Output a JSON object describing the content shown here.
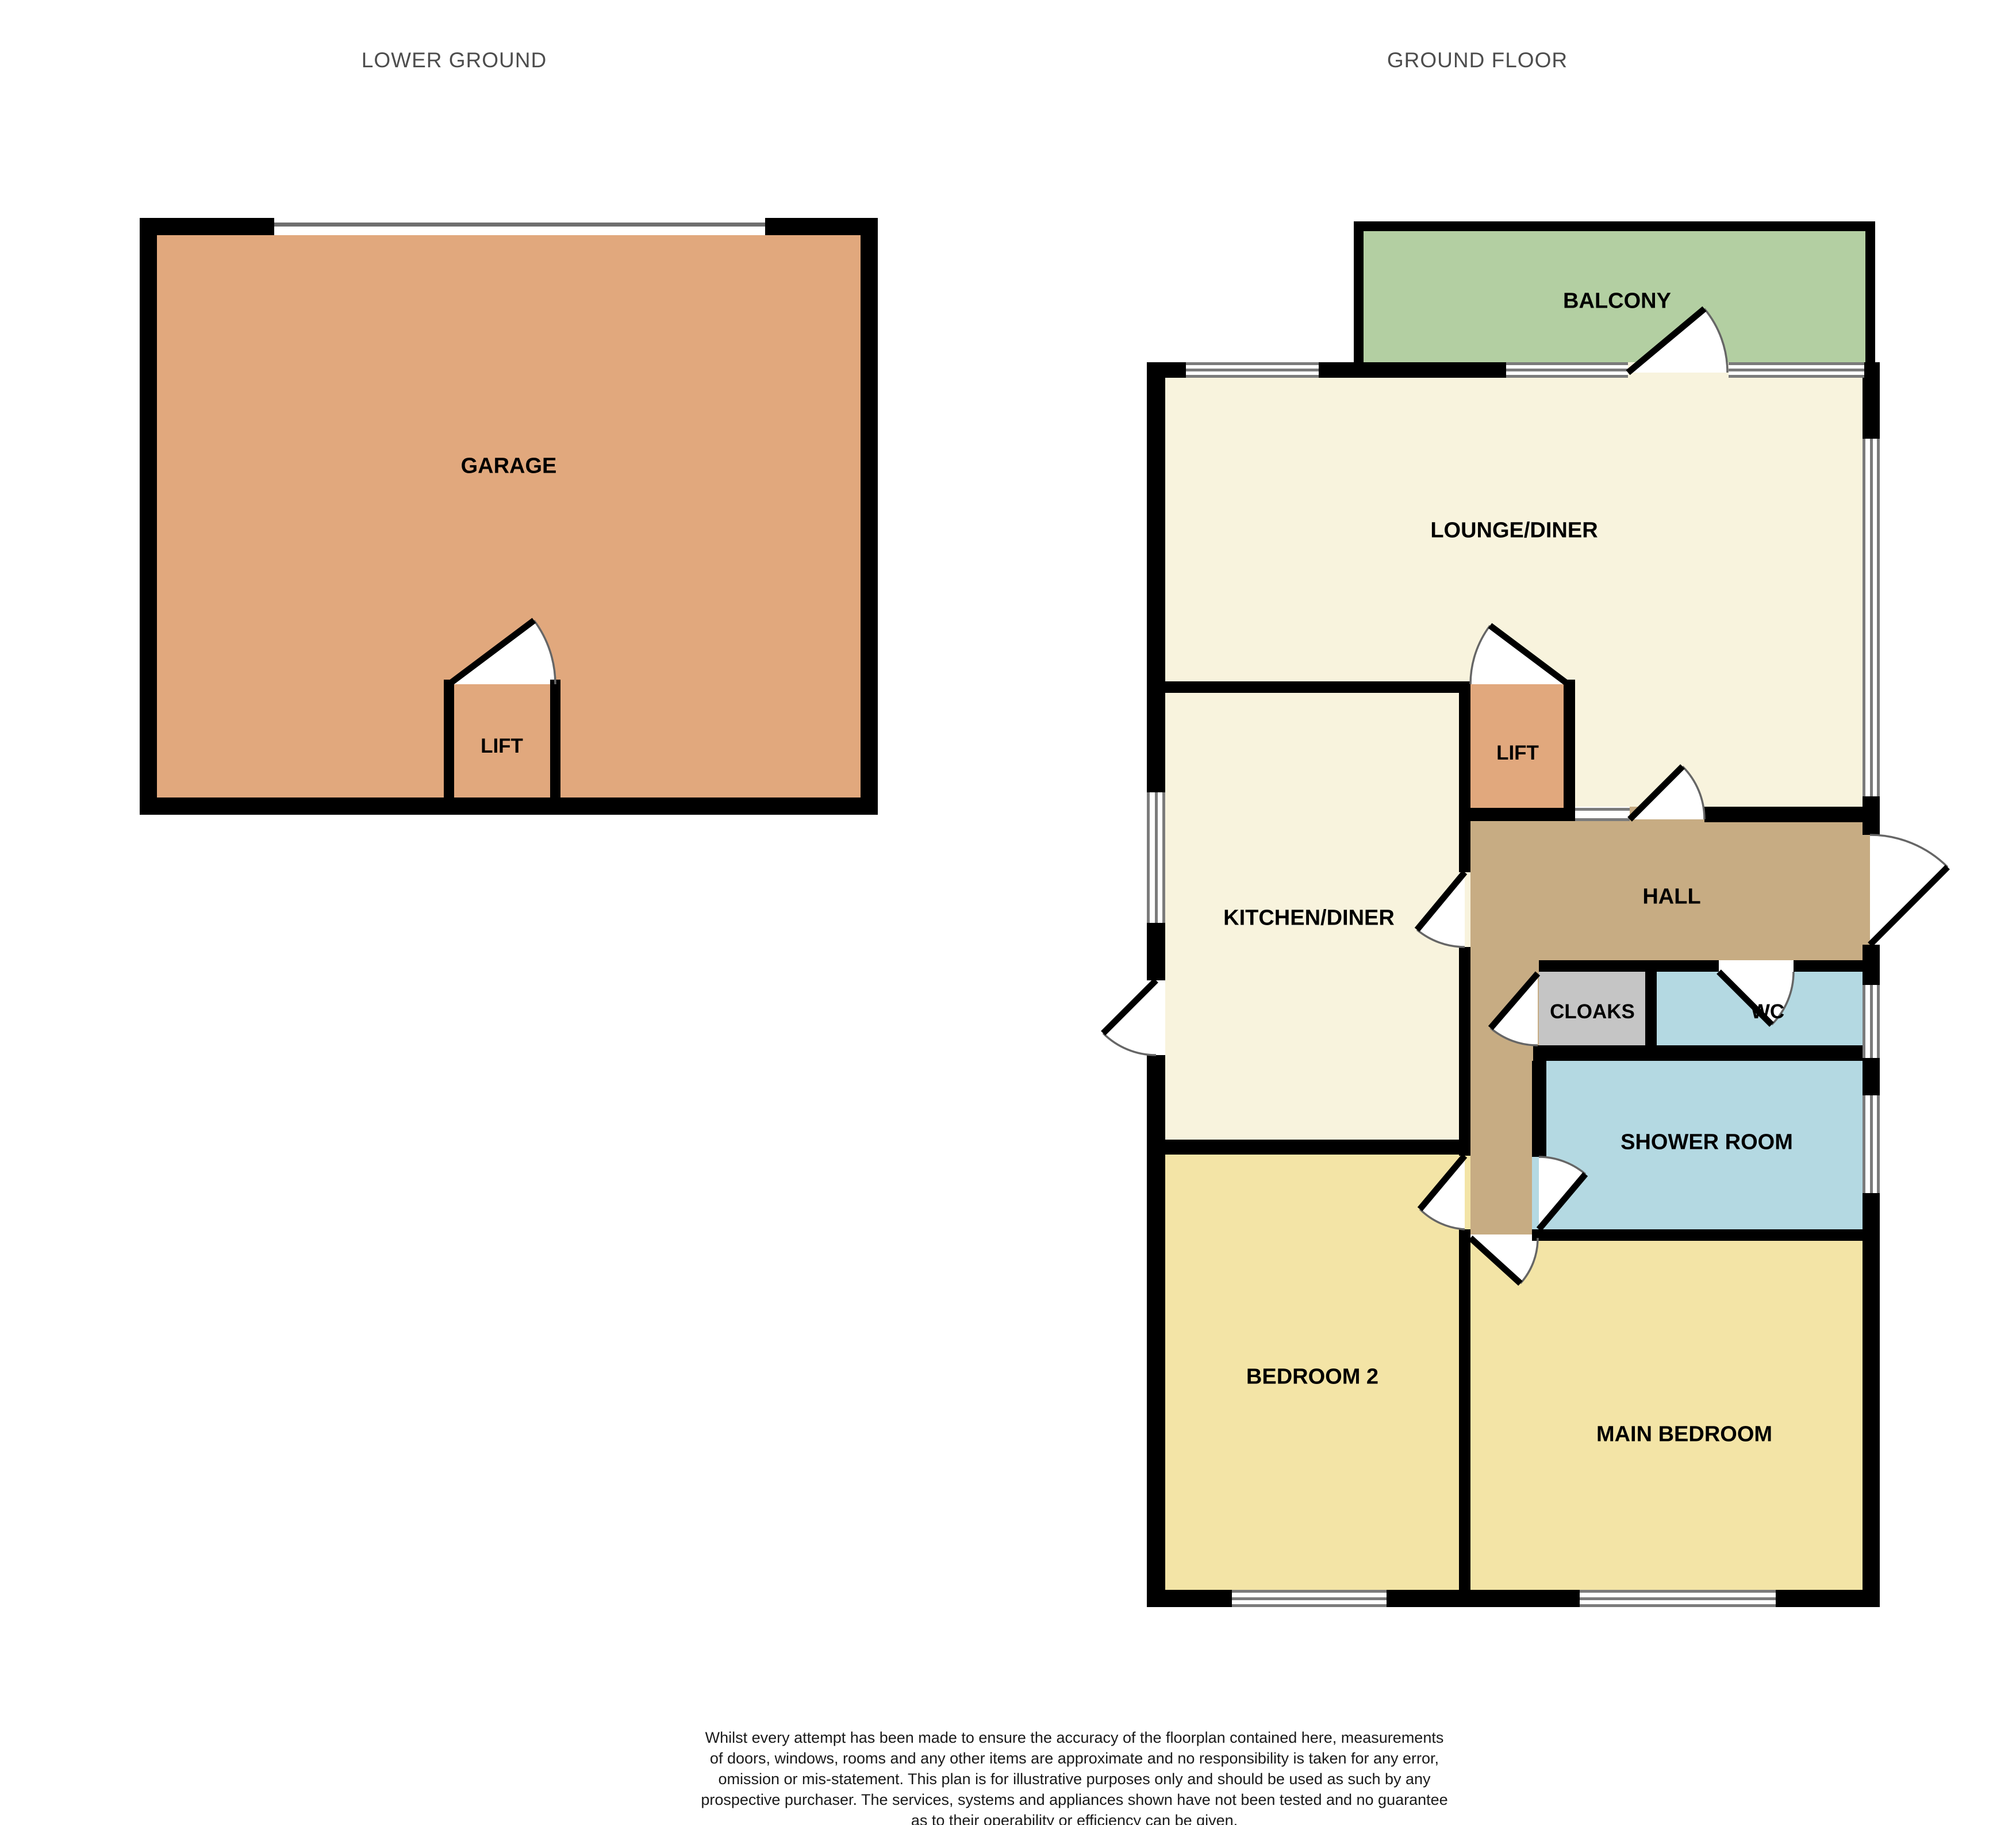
{
  "titles": {
    "lower_ground": "LOWER GROUND",
    "ground_floor": "GROUND FLOOR"
  },
  "rooms": [
    {
      "id": "garage",
      "label": "GARAGE",
      "color": "#e1a87d"
    },
    {
      "id": "lift-lower",
      "label": "LIFT",
      "color": "#e1a87d"
    },
    {
      "id": "balcony",
      "label": "BALCONY",
      "color": "#b3cfa2"
    },
    {
      "id": "lounge-diner",
      "label": "LOUNGE/DINER",
      "color": "#f8f3dd"
    },
    {
      "id": "lift-ground",
      "label": "LIFT",
      "color": "#e1a87d"
    },
    {
      "id": "kitchen-diner",
      "label": "KITCHEN/DINER",
      "color": "#f8f3dd"
    },
    {
      "id": "hall",
      "label": "HALL",
      "color": "#c7ac83"
    },
    {
      "id": "cloaks",
      "label": "CLOAKS",
      "color": "#c5c5c5"
    },
    {
      "id": "wc",
      "label": "WC",
      "color": "#b4d9e2"
    },
    {
      "id": "shower-room",
      "label": "SHOWER ROOM",
      "color": "#b4d9e2"
    },
    {
      "id": "bedroom-2",
      "label": "BEDROOM 2",
      "color": "#f3e4a6"
    },
    {
      "id": "main-bedroom",
      "label": "MAIN BEDROOM",
      "color": "#f3e4a6"
    }
  ],
  "colors": {
    "wall": "#000000",
    "window_line": "#7b7b7b",
    "door_arc": "#666666",
    "title_text": "#4d4d4d",
    "label_text": "#000000",
    "background": "#ffffff"
  },
  "footer": {
    "lines": [
      "Whilst every attempt has been made to ensure the accuracy of the floorplan contained here, measurements",
      "of doors, windows, rooms and any other items are approximate and no responsibility is taken for any error,",
      "omission or mis-statement. This plan is for illustrative purposes only and should be used as such by any",
      "prospective purchaser. The services, systems and appliances shown have not been tested and no guarantee",
      "as to their operability or efficiency can be given.",
      "Made with Metropix ©2025"
    ]
  }
}
